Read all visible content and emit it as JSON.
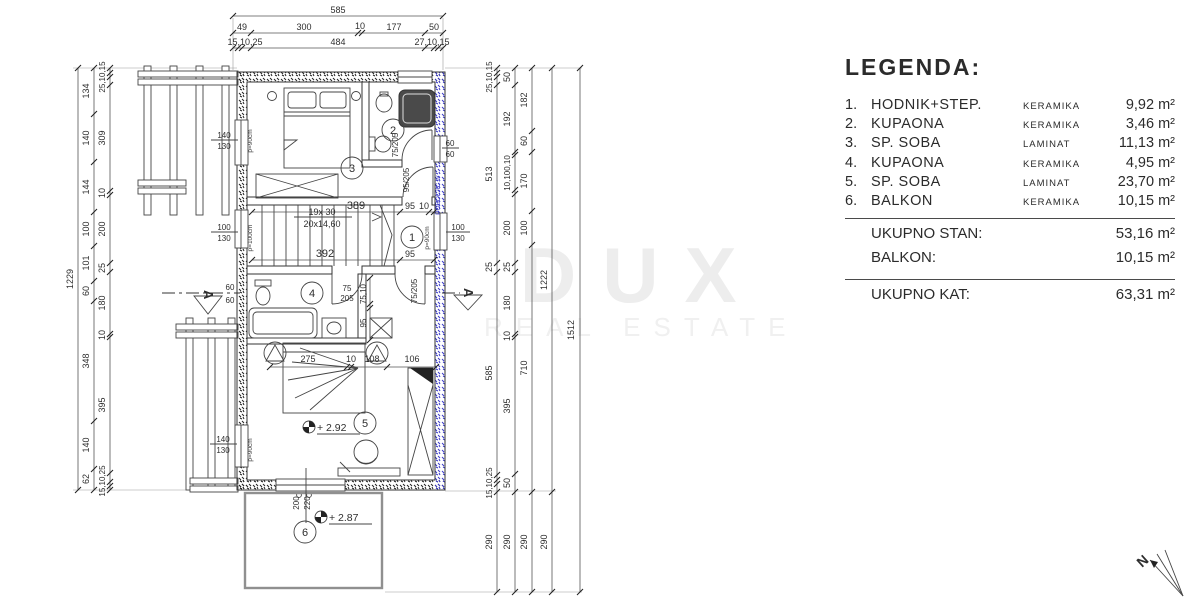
{
  "legend": {
    "title": "LEGENDA:",
    "items": [
      {
        "num": "1.",
        "name": "HODNIK+STEP.",
        "material": "KERAMIKA",
        "area": "9,92 m²"
      },
      {
        "num": "2.",
        "name": "KUPAONA",
        "material": "KERAMIKA",
        "area": "3,46 m²"
      },
      {
        "num": "3.",
        "name": "SP. SOBA",
        "material": "LAMINAT",
        "area": "11,13 m²"
      },
      {
        "num": "4.",
        "name": "KUPAONA",
        "material": "KERAMIKA",
        "area": "4,95 m²"
      },
      {
        "num": "5.",
        "name": "SP. SOBA",
        "material": "LAMINAT",
        "area": "23,70 m²"
      },
      {
        "num": "6.",
        "name": "BALKON",
        "material": "KERAMIKA",
        "area": "10,15 m²"
      }
    ],
    "totals": [
      {
        "label": "UKUPNO STAN:",
        "value": "53,16 m²"
      },
      {
        "label": "BALKON:",
        "value": "10,15 m²"
      }
    ],
    "grand_total": {
      "label": "UKUPNO KAT:",
      "value": "63,31 m²"
    }
  },
  "watermark": {
    "line1": "DUX",
    "line2": "REAL ESTATE"
  },
  "plan": {
    "top_dims": {
      "total": "585",
      "row2": [
        "49",
        "300",
        "10",
        "177",
        "50"
      ],
      "row3": [
        "15,10,25",
        "484",
        "27,10,15"
      ]
    },
    "left_dims": {
      "total": "1229",
      "chain_b": [
        "134",
        "140",
        "144",
        "100",
        "101",
        "60",
        "348",
        "140",
        "62"
      ],
      "chain_c": [
        "25,10,15",
        "309",
        "10",
        "200",
        "25",
        "180",
        "10",
        "395",
        "15,10,25"
      ]
    },
    "right_dims": {
      "chain_1": [
        "25,10,15",
        "513",
        "25",
        "585",
        "15,10,25",
        "290"
      ],
      "chain_2": [
        "50",
        "192",
        "10,100,10",
        "200",
        "25",
        "180",
        "10",
        "395",
        "50",
        "290"
      ],
      "chain_3": [
        "182",
        "60",
        "170",
        "100",
        "710",
        "290"
      ],
      "chain_4": [
        "1222",
        "290"
      ],
      "chain_5": [
        "1512"
      ]
    },
    "rooms": [
      "1",
      "2",
      "3",
      "4",
      "5",
      "6"
    ],
    "interior": {
      "stair_dim_top": "389",
      "stair_dim_bottom": "392",
      "stair_steps": "19x 30",
      "stair_rise": "20x14,60",
      "stair_right_top_a": "95",
      "stair_right_top_b": "10",
      "stair_right_bottom": "95",
      "bed_chain": [
        "275",
        "10",
        "108",
        "106"
      ],
      "room4_vdim": [
        "75,10",
        "95"
      ],
      "balcony_door": {
        "n": "200",
        "d": "220"
      },
      "levels": [
        "+ 2.92",
        "+ 2.87"
      ],
      "windows": [
        {
          "n": "140",
          "d": "130"
        },
        {
          "n": "100",
          "d": "130"
        },
        {
          "n": "140",
          "d": "130"
        },
        {
          "n": "100",
          "d": "130"
        },
        {
          "n": "60",
          "d": "60"
        },
        {
          "n": "60",
          "d": "60"
        }
      ],
      "doors": [
        "75/205",
        "95/205",
        "75/205"
      ],
      "door4": {
        "n": "75",
        "d": "205"
      },
      "parapets": [
        "p=90cm",
        "p=100cm",
        "p=90cm",
        "p=90cm"
      ],
      "section_letter": "A",
      "side_watermark": "POBOLJIC.hr",
      "north_letter": "N"
    },
    "colors": {
      "insulated_wall_blue": "#3a3ac8",
      "drawing_line": "#333333",
      "balcony_line": "#909090",
      "watermark_gray": "#ededed"
    }
  }
}
